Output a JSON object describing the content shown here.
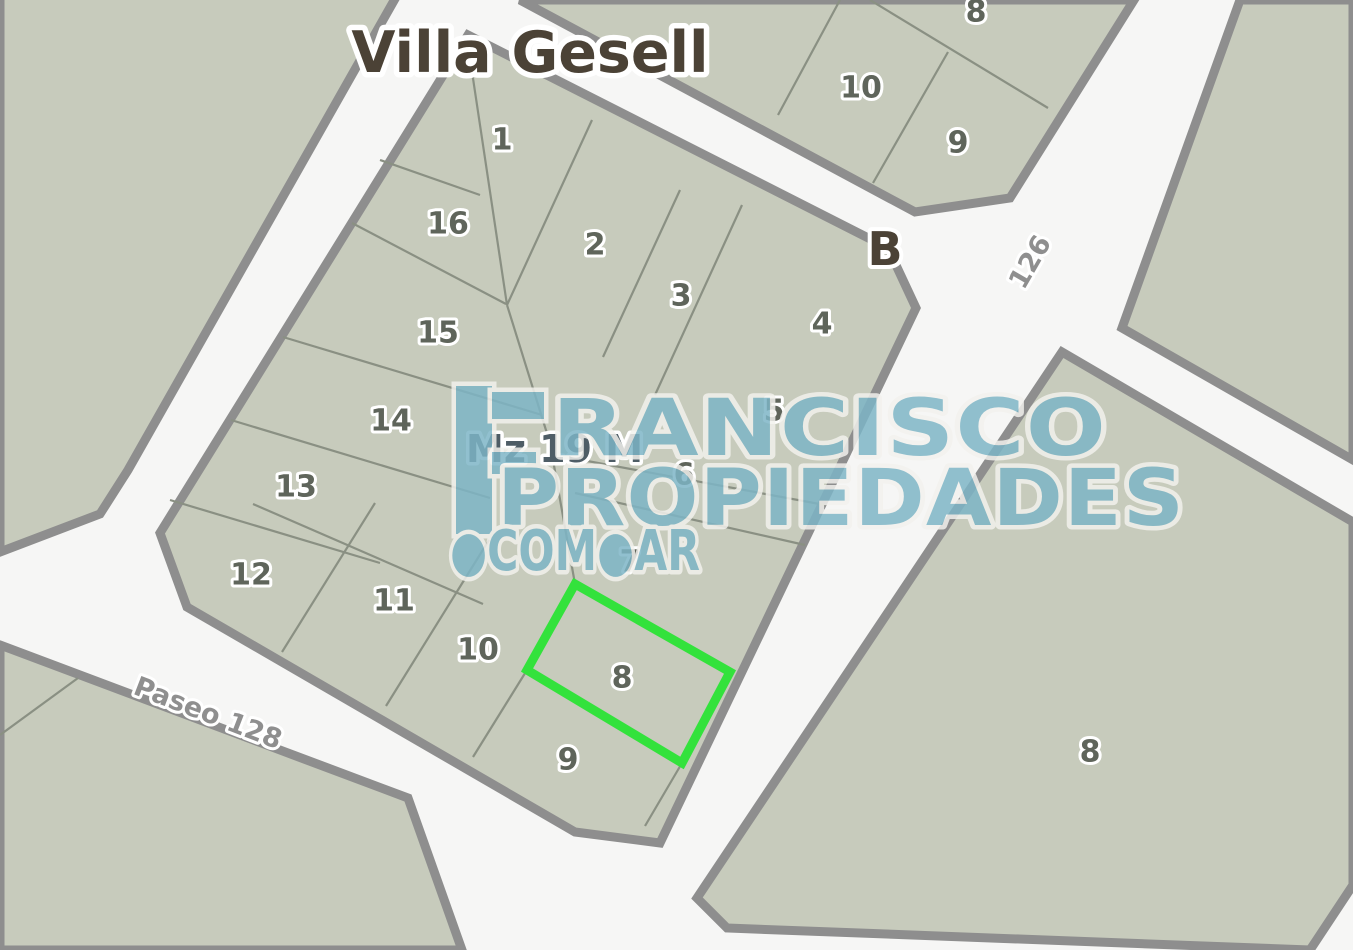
{
  "title": "Villa Gesell",
  "labels": {
    "block": "Mz 19 M",
    "junction": "B"
  },
  "streets": [
    {
      "name": "Paseo 128"
    },
    {
      "name": "126"
    }
  ],
  "watermark": {
    "line1": "RANCISCO",
    "line2": "PROPIEDADES",
    "line3": "●COM●AR"
  },
  "blocks": {
    "main": {
      "label": "Mz 19 M",
      "lots": [
        {
          "n": "1",
          "x": 502,
          "y": 140
        },
        {
          "n": "16",
          "x": 448,
          "y": 224
        },
        {
          "n": "2",
          "x": 595,
          "y": 245
        },
        {
          "n": "3",
          "x": 681,
          "y": 296
        },
        {
          "n": "4",
          "x": 822,
          "y": 324
        },
        {
          "n": "15",
          "x": 438,
          "y": 333
        },
        {
          "n": "5",
          "x": 774,
          "y": 411
        },
        {
          "n": "14",
          "x": 391,
          "y": 421
        },
        {
          "n": "6",
          "x": 684,
          "y": 475
        },
        {
          "n": "13",
          "x": 296,
          "y": 487
        },
        {
          "n": "7",
          "x": 630,
          "y": 562
        },
        {
          "n": "12",
          "x": 251,
          "y": 575
        },
        {
          "n": "11",
          "x": 394,
          "y": 601
        },
        {
          "n": "10",
          "x": 478,
          "y": 650
        },
        {
          "n": "8",
          "x": 622,
          "y": 678,
          "highlighted": true
        },
        {
          "n": "9",
          "x": 568,
          "y": 760
        }
      ]
    },
    "top_right": {
      "lots": [
        {
          "n": "8",
          "x": 976,
          "y": 12
        },
        {
          "n": "10",
          "x": 861,
          "y": 88
        },
        {
          "n": "9",
          "x": 958,
          "y": 143
        }
      ]
    },
    "east": {
      "lots": [
        {
          "n": "8",
          "x": 1090,
          "y": 752
        }
      ]
    }
  },
  "highlight": {
    "lot": "8",
    "color": "#33e23c"
  },
  "colors": {
    "parcel": "#c7cbbc",
    "road": "#f6f6f5",
    "casing": "#8e8e8e",
    "line": "#8a9083",
    "lot_text": "#5f655b",
    "title_text": "#4b4236",
    "block_text": "#4e5d66",
    "street_text": "#8f8f8f",
    "brand": "#7db5c6"
  }
}
